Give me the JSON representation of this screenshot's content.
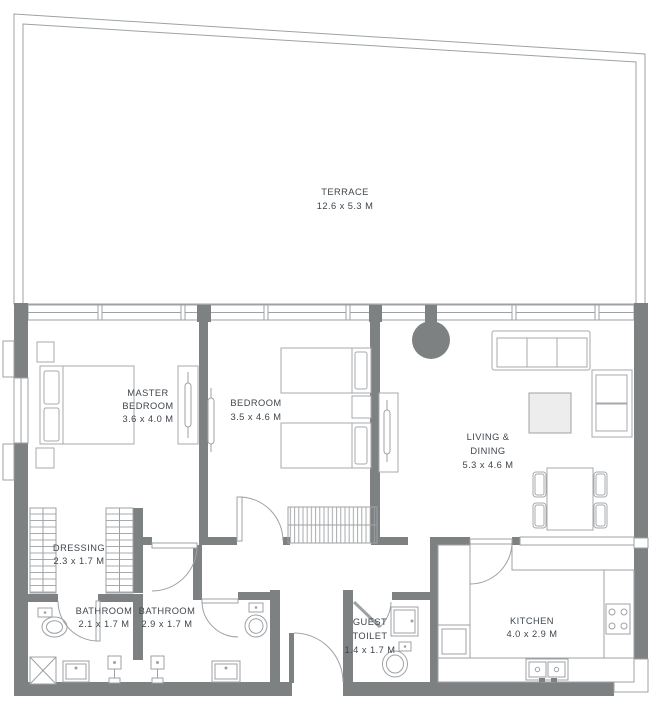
{
  "colors": {
    "wall": "#7e8182",
    "line": "#9da2a5",
    "furn": "#a5a9ac",
    "text": "#3f464d"
  },
  "labels": {
    "terrace": {
      "name": "TERRACE",
      "dims": "12.6 x 5.3 M"
    },
    "master_bedroom": {
      "line1": "MASTER",
      "line2": "BEDROOM",
      "dims": "3.6 x 4.0 M"
    },
    "bedroom": {
      "name": "BEDROOM",
      "dims": "3.5 x 4.6 M"
    },
    "living_dining": {
      "line1": "LIVING &",
      "line2": "DINING",
      "dims": "5.3 x 4.6 M"
    },
    "dressing": {
      "name": "DRESSING",
      "dims": "2.3 x 1.7 M"
    },
    "bathroom_master": {
      "name": "BATHROOM",
      "dims": "2.1 x 1.7 M"
    },
    "bathroom_second": {
      "name": "BATHROOM",
      "dims": "2.9 x 1.7 M"
    },
    "guest_toilet": {
      "line1": "GUEST",
      "line2": "TOILET",
      "dims": "1.4 x 1.7 M"
    },
    "kitchen": {
      "name": "KITCHEN",
      "dims": "4.0 x 2.9 M"
    }
  }
}
